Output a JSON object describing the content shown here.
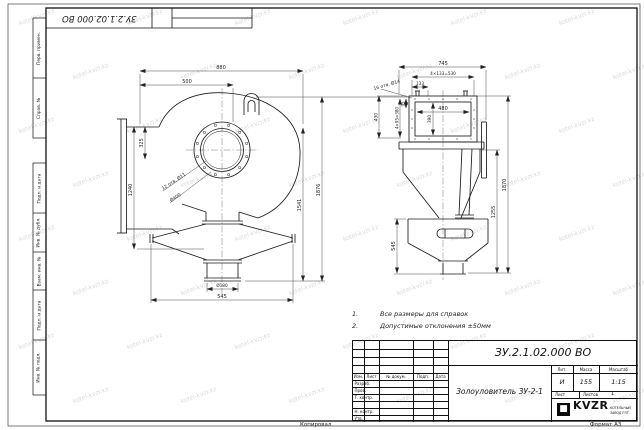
{
  "watermark": {
    "text": "kotel-kvzr.kz"
  },
  "frame": {
    "top_stamp": "ЗУ.2.1.02.000 ВО",
    "side_labels_top": [
      "Перв. примен.",
      "Справ. №"
    ],
    "side_labels_bottom": [
      "Подп. и дата",
      "Инв. № дубл.",
      "Взам. инв. №",
      "Подп. и дата",
      "Инв. № подл."
    ],
    "copied_label": "Копировал",
    "format_label": "Формат А3"
  },
  "notes": {
    "items": [
      {
        "num": "1.",
        "text": "Все размеры для справок"
      },
      {
        "num": "2.",
        "text": "Допустимые отклонения ±50мм"
      }
    ]
  },
  "views": {
    "front": {
      "dims": {
        "w880": "880",
        "w500": "500",
        "h325": "325",
        "h1240": "1240",
        "h1541": "1541",
        "h1876": "1876",
        "holes": "12 отв. Ø11",
        "d400": "Ø400",
        "d180": "Ø180",
        "w545": "545"
      }
    },
    "side": {
      "dims": {
        "w745": "745",
        "pitch_h": "4×133=530",
        "w133": "133",
        "w480": "480",
        "h390": "390",
        "h95": "95",
        "pitch_v": "4×95=380",
        "h430": "430",
        "holes": "16 отв. Ø14",
        "h1255": "1255",
        "h1870": "1870",
        "h545": "545"
      }
    }
  },
  "title_block": {
    "doc_number": "ЗУ.2.1.02.000 ВО",
    "title": "Золоуловитель ЗУ-2-1",
    "cols": [
      "Изм.",
      "Лист",
      "№ докум.",
      "Подп.",
      "Дата"
    ],
    "rows": [
      "Разраб.",
      "Пров.",
      "Т. контр.",
      "Н. контр.",
      "Утв."
    ],
    "lit_header": "Лит.",
    "mass_header": "Масса",
    "scale_header": "Масштаб",
    "lit": "И",
    "mass": "155",
    "scale": "1:15",
    "sheet_header": "Лист",
    "sheets_header": "Листов",
    "sheets": "1",
    "logo_text": "KVZR",
    "logo_sub1": "КОТЕЛЬНЫЙ",
    "logo_sub2": "ЗАВОД РЛТ"
  }
}
